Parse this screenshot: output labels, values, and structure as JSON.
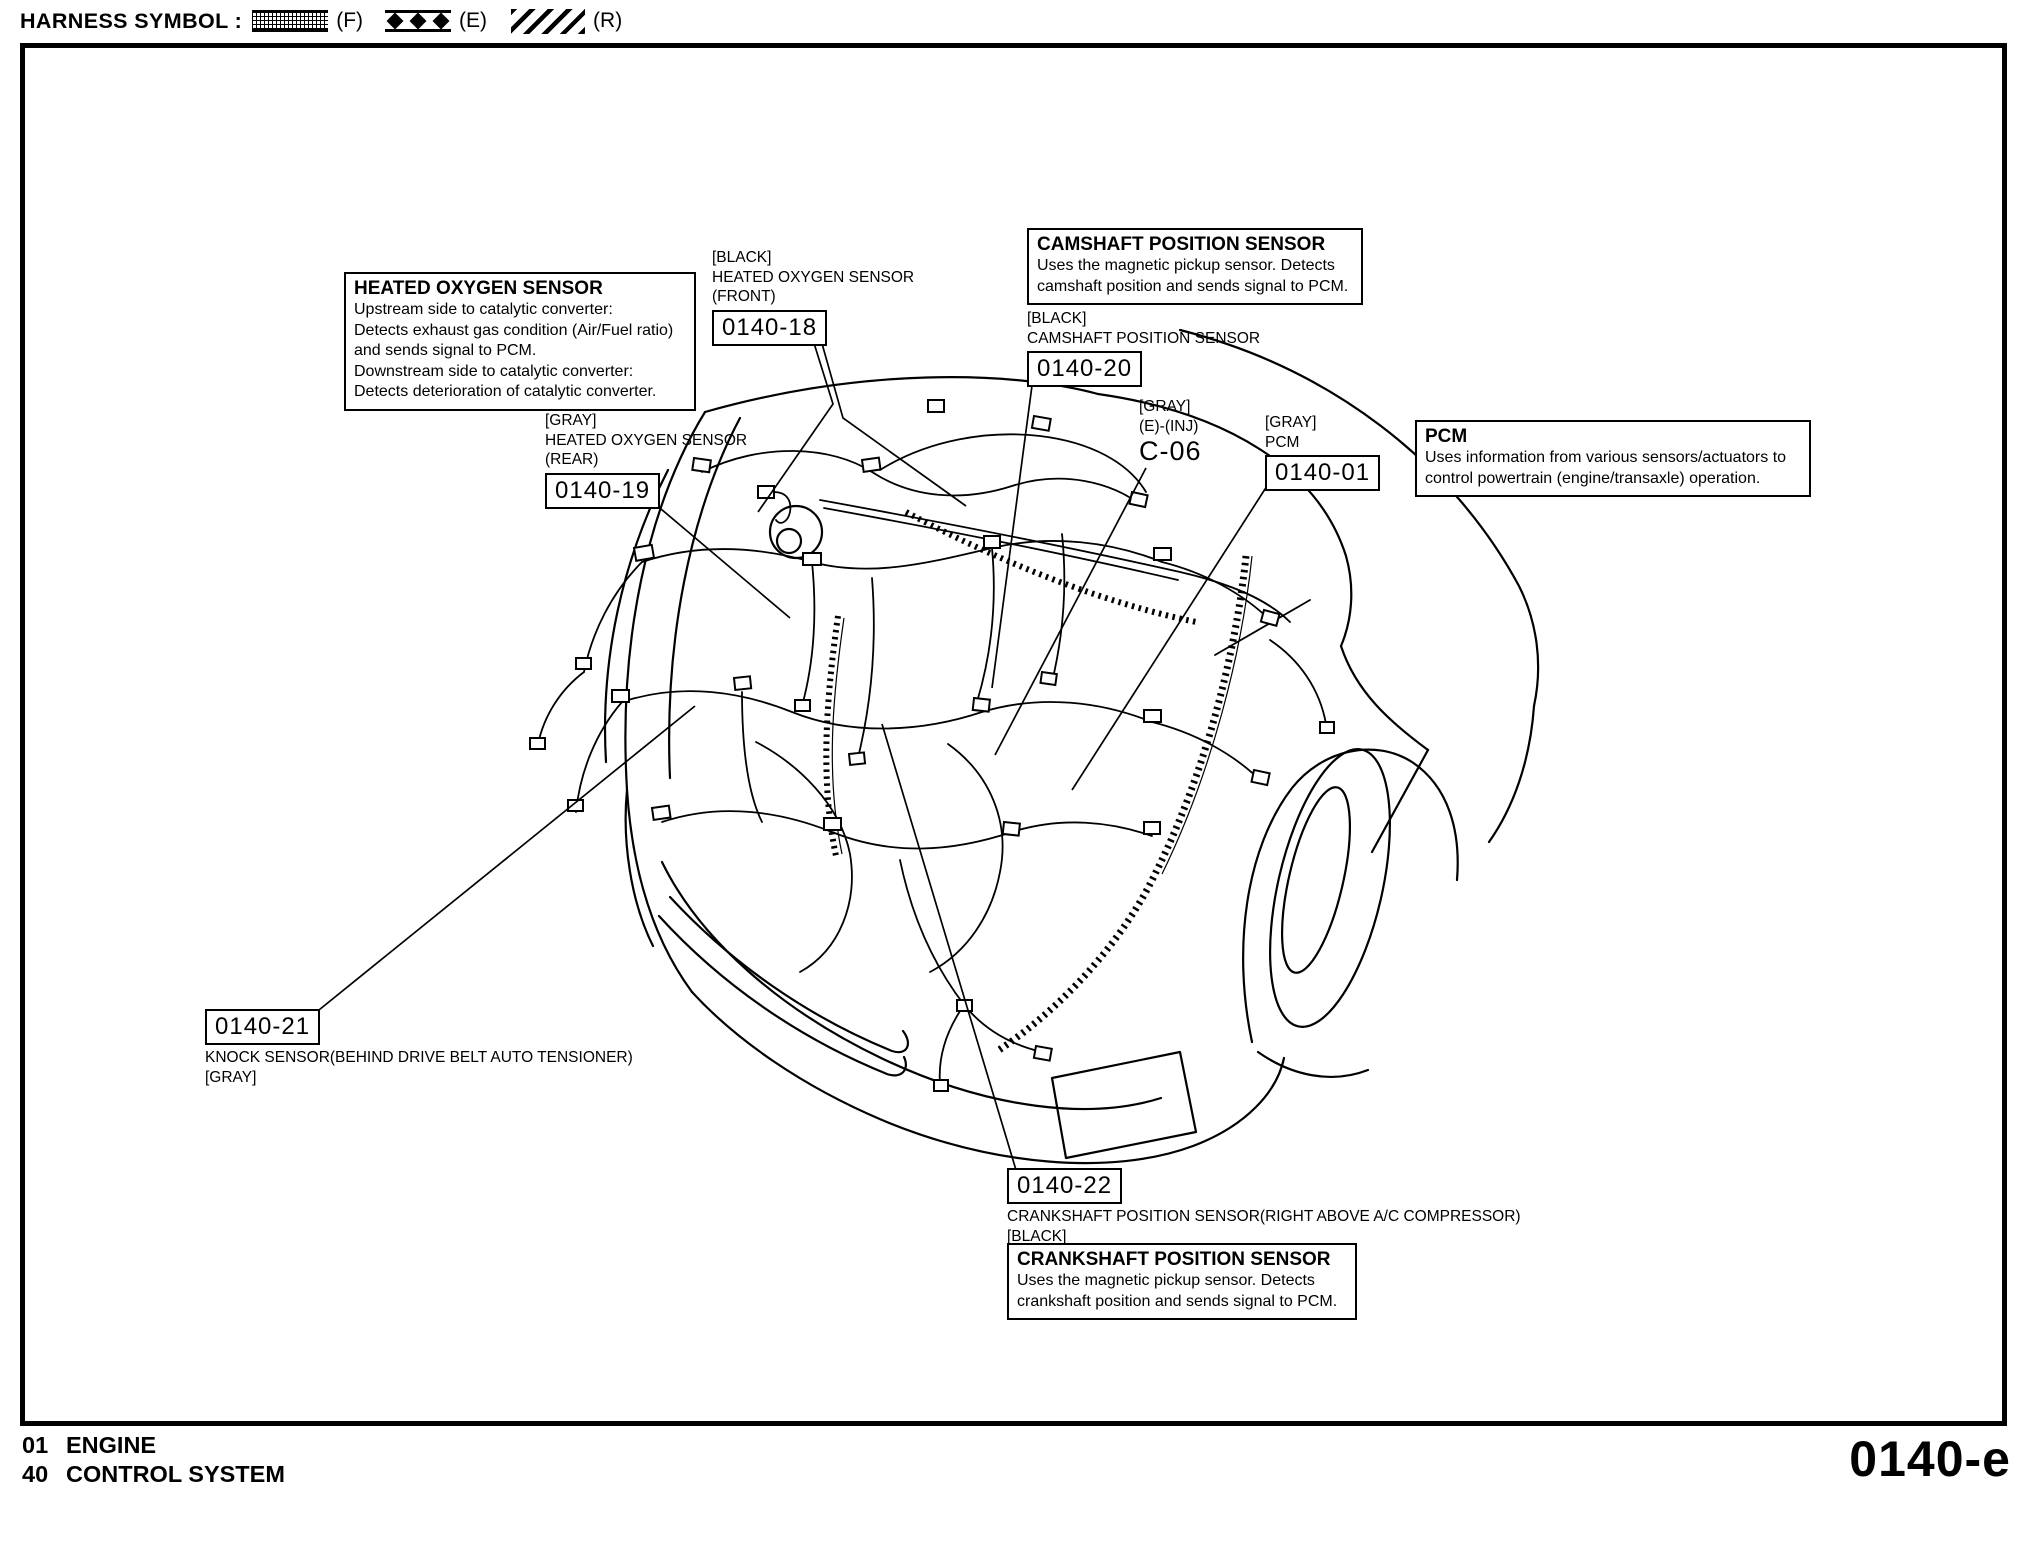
{
  "header": {
    "label": "HARNESS SYMBOL :",
    "symbols": [
      {
        "id": "front-harness",
        "letter": "(F)"
      },
      {
        "id": "engine-harness",
        "letter": "(E)"
      },
      {
        "id": "rear-harness",
        "letter": "(R)"
      }
    ]
  },
  "info_boxes": {
    "heated_oxygen_sensor": {
      "title": "HEATED OXYGEN SENSOR",
      "lines": [
        "Upstream side to catalytic converter:",
        "Detects exhaust gas condition (Air/Fuel ratio)",
        "and sends signal to PCM.",
        "Downstream side to catalytic converter:",
        "Detects deterioration of catalytic converter."
      ]
    },
    "camshaft": {
      "title": "CAMSHAFT POSITION SENSOR",
      "lines": [
        "Uses the magnetic pickup sensor. Detects",
        "camshaft position and sends signal to PCM."
      ]
    },
    "pcm": {
      "title": "PCM",
      "lines": [
        "Uses information from various sensors/actuators to",
        "control powertrain (engine/transaxle) operation."
      ]
    },
    "crankshaft": {
      "title": "CRANKSHAFT POSITION SENSOR",
      "lines": [
        "Uses the magnetic pickup sensor. Detects",
        "crankshaft position and sends signal to PCM."
      ]
    }
  },
  "connector_labels": {
    "hos_front": {
      "lines": [
        "[BLACK]",
        "HEATED OXYGEN SENSOR",
        "(FRONT)"
      ],
      "ref": "0140-18"
    },
    "camshaft": {
      "lines": [
        "[BLACK]",
        "CAMSHAFT POSITION SENSOR"
      ],
      "ref": "0140-20"
    },
    "hos_rear": {
      "lines": [
        "[GRAY]",
        "HEATED OXYGEN SENSOR",
        "(REAR)"
      ],
      "ref": "0140-19"
    },
    "injector": {
      "lines": [
        "[GRAY]",
        "(E)-(INJ)"
      ],
      "code": "C-06"
    },
    "pcm": {
      "lines": [
        "[GRAY]",
        "PCM"
      ],
      "ref": "0140-01"
    },
    "knock": {
      "ref": "0140-21",
      "lines": [
        "KNOCK SENSOR(BEHIND DRIVE BELT AUTO TENSIONER)",
        "[GRAY]"
      ]
    },
    "crankshaft": {
      "ref": "0140-22",
      "lines": [
        "CRANKSHAFT POSITION SENSOR(RIGHT ABOVE A/C COMPRESSOR)",
        "[BLACK]"
      ]
    }
  },
  "footer": {
    "rows": [
      {
        "num": "01",
        "name": "ENGINE"
      },
      {
        "num": "40",
        "name": "CONTROL SYSTEM"
      }
    ],
    "page_code": "0140-e"
  }
}
